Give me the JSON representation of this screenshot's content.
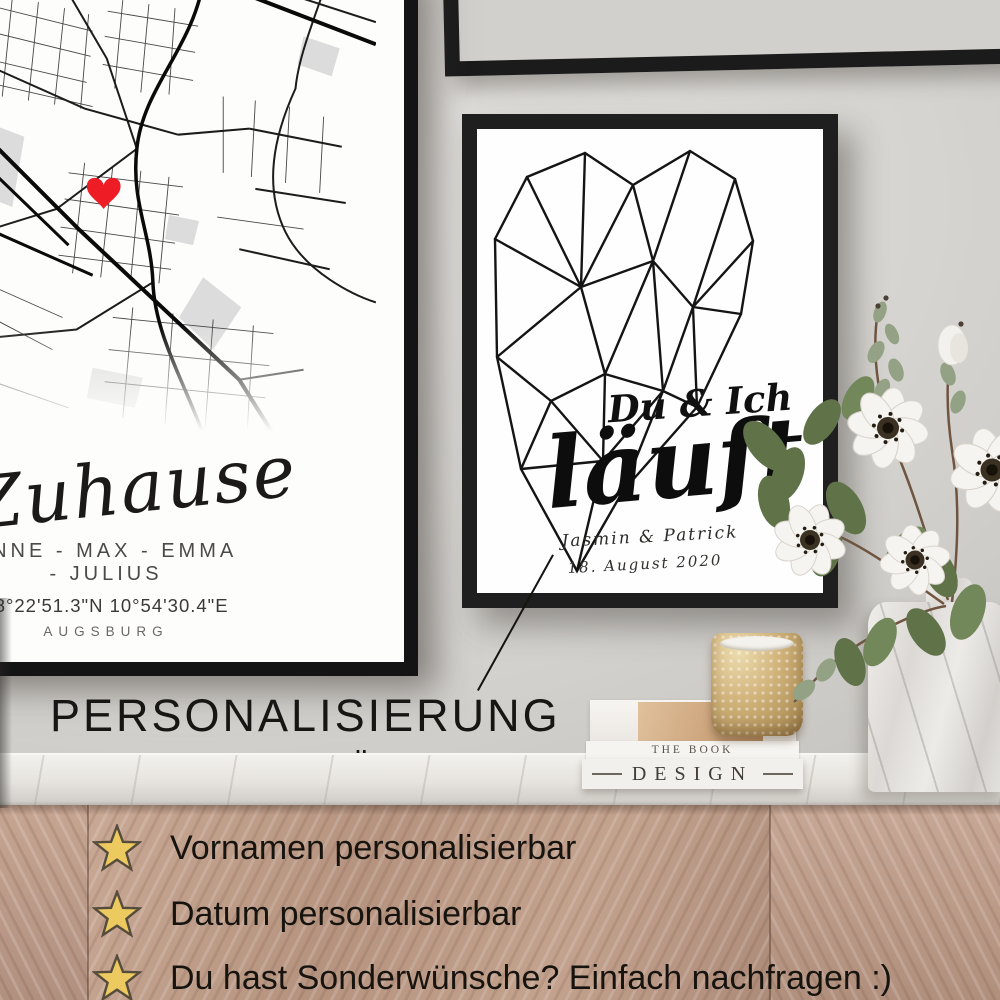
{
  "wall_art": {
    "map_poster": {
      "title": "Zuhause",
      "names": "ANNE - MAX - EMMA - JULIUS",
      "coordinates": "48°22'51.3\"N 10°54'30.4\"E",
      "city": "AUGSBURG",
      "marker_color": "#ee1c25",
      "frame_color": "#141414"
    },
    "heart_poster": {
      "heading": "Du & Ich",
      "script_word": "läuft",
      "names": "Jasmin & Patrick",
      "date": "18. August 2020",
      "frame_color": "#1f1f1f"
    }
  },
  "promo": {
    "headline_line1": "PERSONALISIERUNG",
    "headline_line2": "NACH DEINEN WÜNSCHEN",
    "star_color": "#edca60",
    "features": [
      {
        "icon": "star-icon",
        "text": "Vornamen personalisierbar"
      },
      {
        "icon": "star-icon",
        "text": "Datum personalisierbar"
      },
      {
        "icon": "star-icon",
        "text": "Du hast Sonderwünsche? Einfach nachfragen :)"
      }
    ]
  },
  "decor": {
    "books": {
      "top_spine": "THE BOOK",
      "bottom_spine": "DESIGN"
    }
  }
}
